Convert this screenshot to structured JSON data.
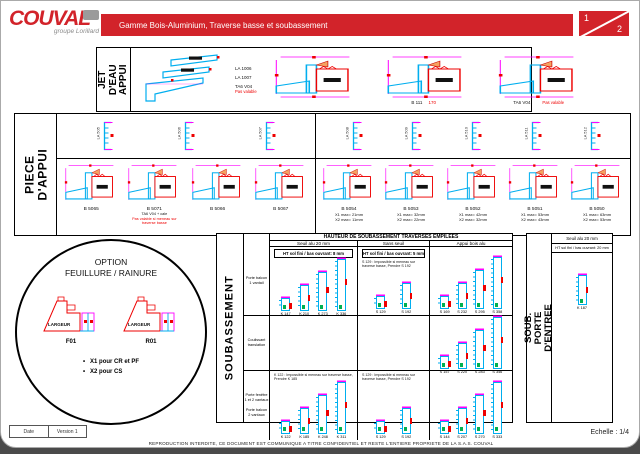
{
  "colors": {
    "accent": "#d2232a",
    "alu": "#00aeef",
    "dim": "#ff00ff",
    "wood": "#ff0000",
    "gasket": "#00b050",
    "wedge": "#f4a261"
  },
  "header": {
    "logo_name": "COUVAL",
    "logo_tagline": "groupe Lorillard",
    "title": "Gamme Bois-Aluminium, Traverse basse et soubassement",
    "page_current": "1",
    "page_total": "2"
  },
  "jet_deau": {
    "label": "JET D'EAU\nAPPUI",
    "callouts": [
      {
        "text": "LA 1006",
        "warn": ""
      },
      {
        "text": "LA 1007",
        "warn": ""
      },
      {
        "text": "TA6 V04",
        "warn": "Pas valable"
      }
    ],
    "sections": [
      {
        "ref": "",
        "dim": "",
        "warn": ""
      },
      {
        "ref": "B 111",
        "dim": "170",
        "warn": ""
      },
      {
        "ref": "TA6 V04",
        "dim": "",
        "warn": "Pas valable"
      }
    ]
  },
  "piece_appui": {
    "label": "PIECE D'APPUI",
    "top_profiles_left": [
      "LA 505",
      "LA 506",
      "LA 507"
    ],
    "top_profiles_right": [
      "LA 508",
      "LA 509",
      "LA 510",
      "LA 511",
      "LA 512"
    ],
    "sections_left": [
      {
        "ref": "B 5065",
        "x1": "",
        "x2": "",
        "note": "",
        "warn": ""
      },
      {
        "ref": "B 5071",
        "x1": "",
        "x2": "",
        "note": "TA6 V04 + cale",
        "warn": "Pas valable si meneau sur traverse basse"
      },
      {
        "ref": "B 5066",
        "x1": "",
        "x2": "",
        "note": "",
        "warn": ""
      },
      {
        "ref": "B 5067",
        "x1": "",
        "x2": "",
        "note": "",
        "warn": ""
      }
    ],
    "sections_right": [
      {
        "ref": "B 5054",
        "x1": "X1 max= 21mm",
        "x2": "X2 max= 11mm",
        "note": "",
        "warn": ""
      },
      {
        "ref": "B 5053",
        "x1": "X1 max= 32mm",
        "x2": "X2 max= 22mm",
        "note": "",
        "warn": ""
      },
      {
        "ref": "B 5052",
        "x1": "X1 max= 42mm",
        "x2": "X2 max= 32mm",
        "note": "",
        "warn": ""
      },
      {
        "ref": "B 5051",
        "x1": "X1 max= 53mm",
        "x2": "X2 max= 43mm",
        "note": "",
        "warn": ""
      },
      {
        "ref": "B 5050",
        "x1": "X1 max= 63mm",
        "x2": "X2 max= 53mm",
        "note": "",
        "warn": ""
      }
    ]
  },
  "option_circle": {
    "title": "OPTION\nFEUILLURE / RAINURE",
    "drawings": [
      {
        "inner": "LARGEUR",
        "caption": "F01"
      },
      {
        "inner": "LARGEUR",
        "caption": "R01"
      }
    ],
    "bullets": [
      "X1 pour CR et PF",
      "X2 pour CS"
    ]
  },
  "soubassement": {
    "label": "SOUBASSEMENT",
    "title": "HAUTEUR DE SOUBASSEMENT TRAVERSES EMPILEES",
    "col_headers": [
      "Seuil alu 20 mm",
      "Sans seuil",
      "Appui bois alu"
    ],
    "sub1": "HT sol fini / bas ouvrant: 8 mm",
    "sub2": "HT sol fini / bas ouvrant: 5 mm",
    "rows": {
      "r1": {
        "label": "Porte balcon\n1 vantail"
      },
      "r2": {
        "label": "Coulissant\ntranslation"
      },
      "r3": {
        "label": "Porte fenêtre\n1 et 2 vantaux\n\nPorte balcon\n2 vantaux"
      }
    },
    "r1c1": {
      "refs": [
        "K 147",
        "K 210",
        "K 273",
        "K 336"
      ]
    },
    "r1c2": {
      "note": "S 129 : Impossible si meneau sur traverse basse, Prendre S 192",
      "refs": [
        "S 129",
        "S 192"
      ]
    },
    "r1c3": {
      "refs": [
        "S 169",
        "S 232",
        "S 295",
        "S 358"
      ]
    },
    "r2c3": {
      "refs": [
        "S 157",
        "S 220",
        "S 283",
        "S 346"
      ]
    },
    "r3c1": {
      "note": "K 122 : Impossible si meneau sur traverse basse, Prendre K 185",
      "refs": [
        "K 122",
        "K 185",
        "K 248",
        "K 311"
      ]
    },
    "r3c2": {
      "note": "S 129 : Impossible si meneau sur traverse basse, Prendre S 192",
      "refs": [
        "S 129",
        "S 192"
      ]
    },
    "r3c3": {
      "refs": [
        "S 144",
        "S 207",
        "S 270",
        "S 333"
      ]
    }
  },
  "porte_entree": {
    "label": "SOUB. PORTE\nD'ENTREE",
    "header": "Seuil alu 20 mm",
    "subheader": "HT sol fini / bas ouvrant: 20 mm",
    "ref": "K 187"
  },
  "footer": {
    "date_label": "Date",
    "version_label": "Version 1",
    "notice": "REPRODUCTION INTERDITE, CE DOCUMENT EST COMMUNIQUE A TITRE CONFIDENTIEL ET RESTE L'ENTIERE PROPRIETE DE LA S.A.S. COUVAL",
    "scale": "Echelle : 1/4"
  }
}
